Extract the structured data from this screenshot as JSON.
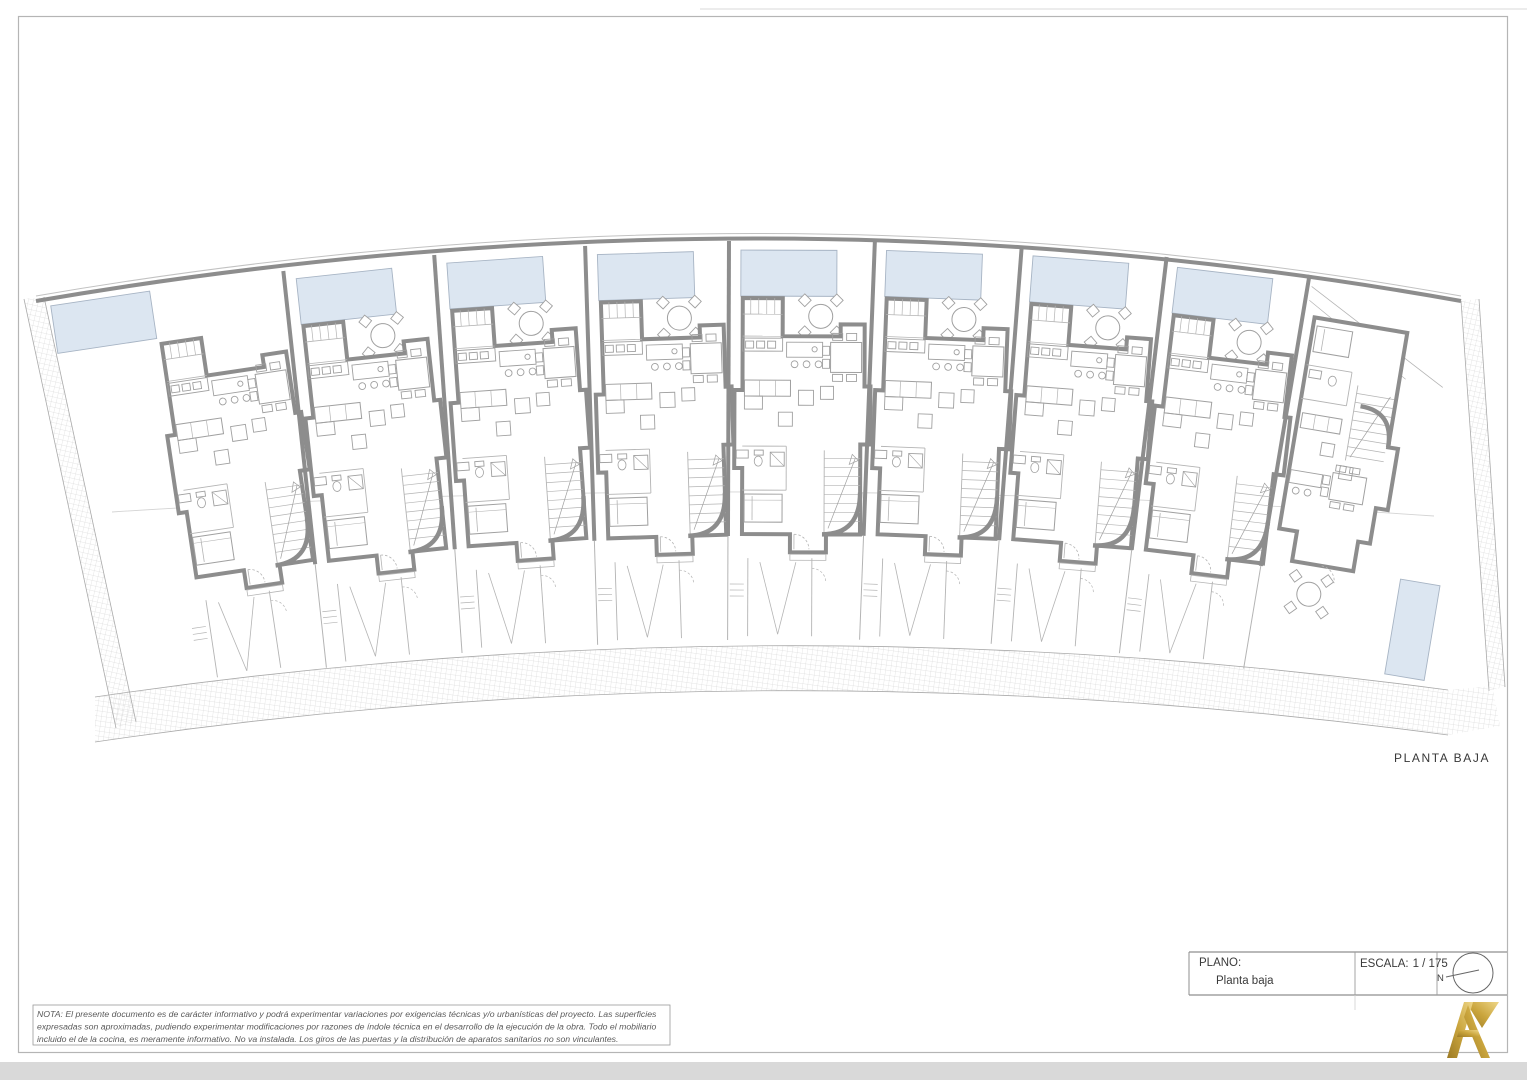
{
  "labels": {
    "plan_name": "PLANTA BAJA",
    "plano_label": "PLANO:",
    "plano_value": "Planta baja",
    "scale_label": "ESCALA:",
    "scale_value": "1 / 175",
    "north_letter": "N"
  },
  "nota": {
    "lines": [
      "NOTA: El presente documento es de carácter informativo y podrá experimentar variaciones por exigencias técnicas y/o urbanísticas del proyecto. Las superficies",
      "expresadas son aproximadas, pudiendo experimentar modificaciones por razones de índole técnica en el desarrollo de la ejecución de la obra. Todo el mobiliario",
      "incluido el de la cocina, es meramente informativo. No va instalada. Los giros de las puertas y la distribución de aparatos sanitarios no son vinculantes."
    ]
  },
  "colors": {
    "pool_fill": "#dce6f1",
    "pool_stroke": "#a7b4c4",
    "wall": "#8d8d8d",
    "thin": "#b4b4b4",
    "furniture": "#a0a0a0",
    "hatch": "#cdcdcd",
    "page_border": "#b5b5b5",
    "gold_dark": "#9c7a24",
    "gold_mid": "#caa53d",
    "gold_light": "#eed688"
  },
  "plan": {
    "unit_count": 9,
    "units": [
      {
        "id": "U1",
        "type": "left",
        "x": 36,
        "y": 302,
        "rot": -8.5,
        "w": 248
      },
      {
        "id": "U2",
        "type": "mid",
        "x": 283,
        "y": 268,
        "rot": -6.2,
        "w": 151
      },
      {
        "id": "U3",
        "type": "mid",
        "x": 434,
        "y": 252,
        "rot": -4.0,
        "w": 151
      },
      {
        "id": "U4",
        "type": "mid",
        "x": 585,
        "y": 243,
        "rot": -1.8,
        "w": 144
      },
      {
        "id": "U5",
        "type": "mid",
        "x": 729,
        "y": 238,
        "rot": 0.2,
        "w": 146
      },
      {
        "id": "U6",
        "type": "mid",
        "x": 875,
        "y": 238,
        "rot": 2.2,
        "w": 147
      },
      {
        "id": "U7",
        "type": "mid",
        "x": 1022,
        "y": 243,
        "rot": 4.4,
        "w": 145
      },
      {
        "id": "U8",
        "type": "mid",
        "x": 1167,
        "y": 254,
        "rot": 6.8,
        "w": 143
      },
      {
        "id": "U9",
        "type": "right",
        "x": 1310,
        "y": 272,
        "rot": 9.5,
        "w": 152
      }
    ]
  }
}
